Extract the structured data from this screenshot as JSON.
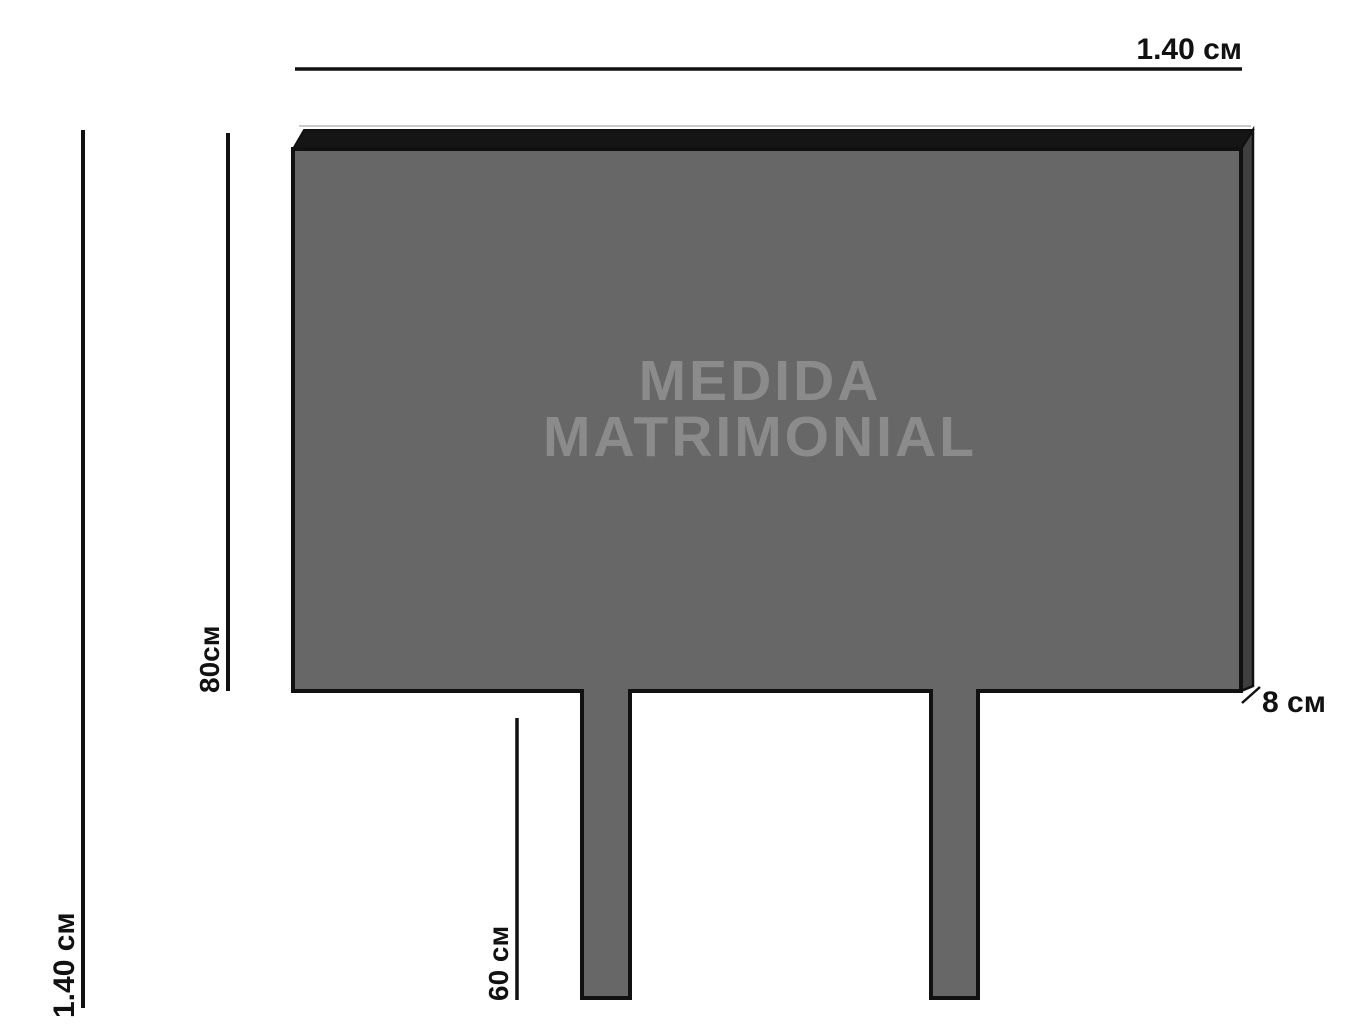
{
  "figure": {
    "title_line1": "MEDIDA",
    "title_line2": "MATRIMONIAL",
    "dimensions": {
      "width_label": "1.40 см",
      "total_height_label": "1.40 см",
      "headboard_height_label": "80см",
      "legs_height_label": "60 см",
      "depth_label": "8 см"
    },
    "colors": {
      "background": "#ffffff",
      "panel_face": "#676767",
      "panel_top": "#151515",
      "panel_side": "#3f3f3f",
      "panel_top_highlight": "#c9c9c9",
      "outline": "#111111",
      "title_text": "#8b8b8b",
      "dimension_text": "#111111"
    }
  }
}
